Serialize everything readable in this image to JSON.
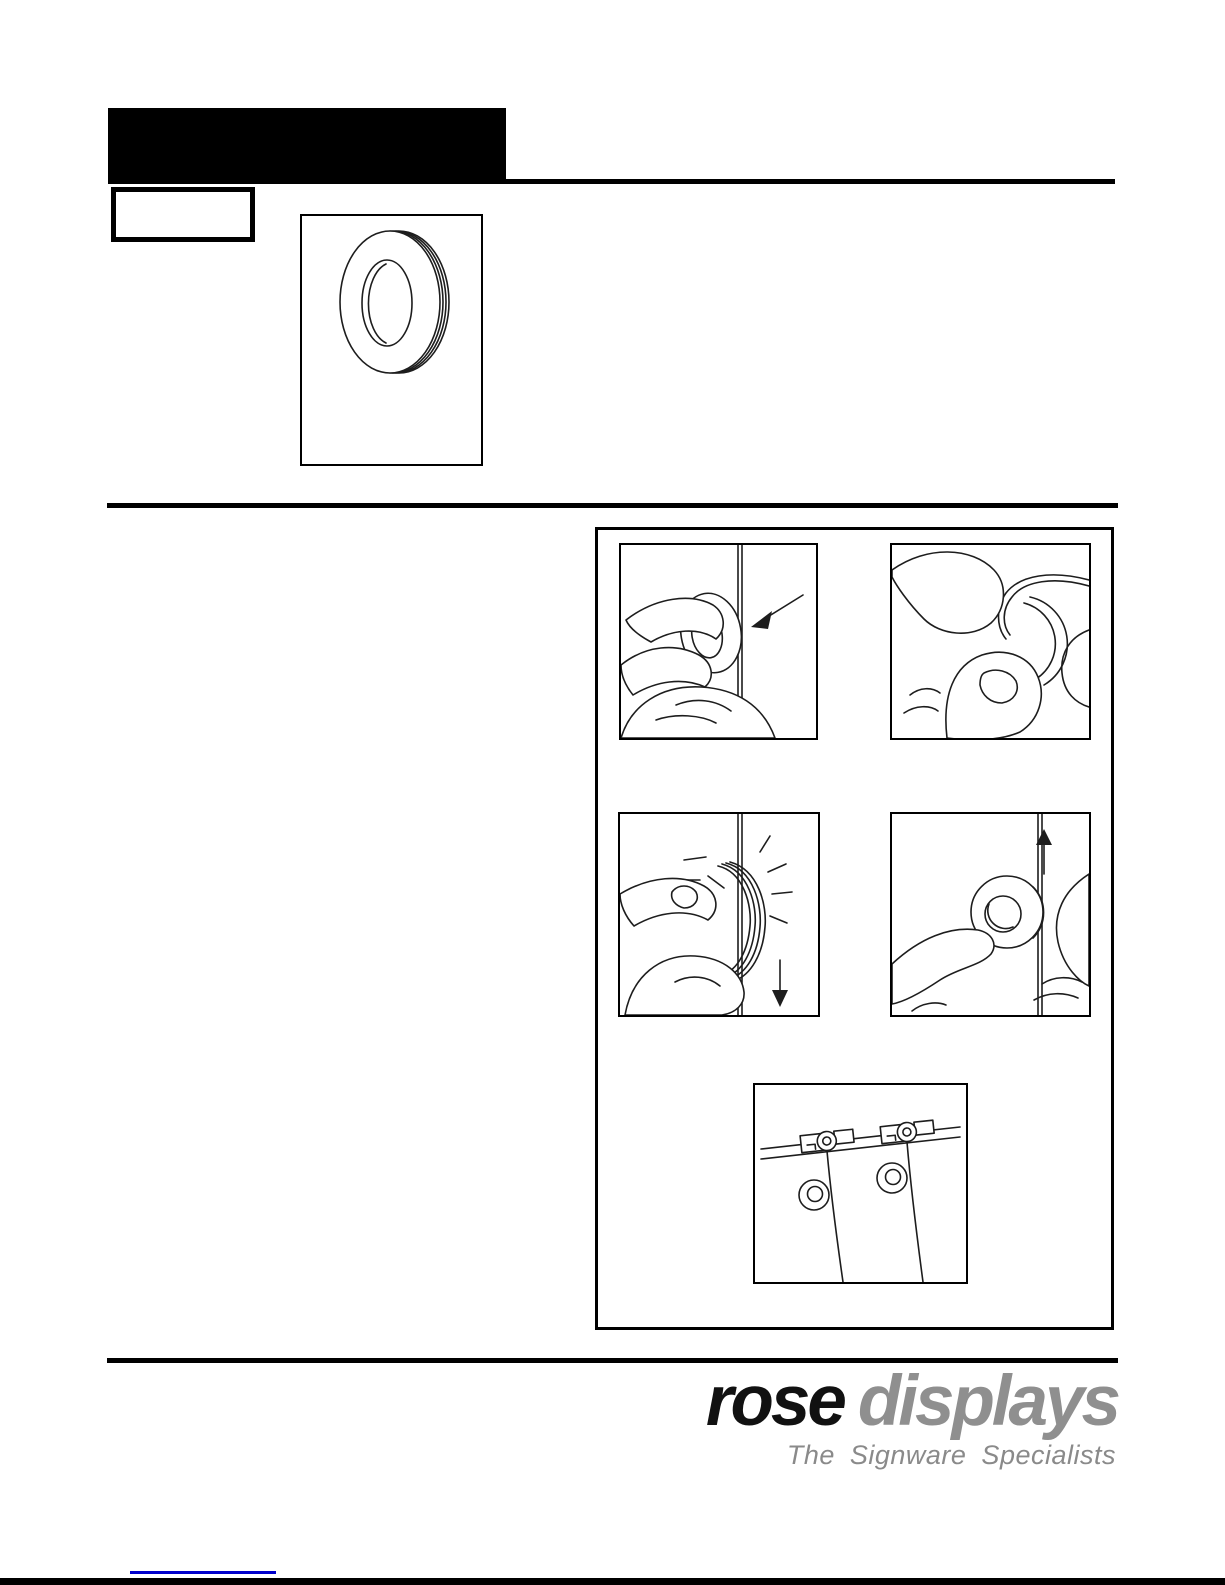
{
  "footer": {
    "logo": {
      "word1": "rose",
      "word2": "displays",
      "tagline": "The Signware Specialists"
    }
  },
  "colors": {
    "ink": "#000000",
    "logo_black": "#111111",
    "logo_gray": "#8f8f8f",
    "slash_red": "#e8352b",
    "link_blue": "#0000cc"
  },
  "images": {
    "product_alt": "nylon ring (grommet) line drawing",
    "step1_alt": "hold ring against hanging cable",
    "step2_alt": "press cable into ring groove with thumbs",
    "step3_alt": "ring snaps onto cable, slide down",
    "step4_alt": "slide ring up the cable",
    "result_alt": "ceiling track with two clips, hanging cables and rings"
  }
}
